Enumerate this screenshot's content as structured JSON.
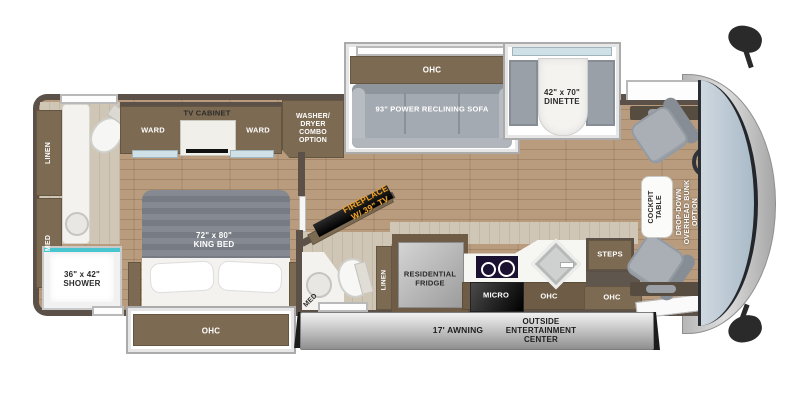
{
  "colors": {
    "wood": "#b89b7d",
    "cabinet": "#7c6a52",
    "wall": "#5b5148",
    "shower_teal": "#49c5cf",
    "fireplace_orange": "#f0a32f"
  },
  "labels": {
    "ohc": "OHC",
    "rear_bath": {
      "linen": "LINEN",
      "med": "MED"
    },
    "bedroom": {
      "ward_left": "WARD",
      "tv_cabinet": "TV CABINET",
      "ward_right": "WARD",
      "bed_size": "72\" x 80\"",
      "bed_name": "KING BED"
    },
    "washer": {
      "l1": "WASHER/",
      "l2": "DRYER",
      "l3": "COMBO",
      "l4": "OPTION"
    },
    "shower": {
      "size": "36\" x 42\"",
      "name": "SHOWER"
    },
    "sofa": "93\" POWER RECLINING SOFA",
    "dinette": {
      "size": "42\" x 70\"",
      "name": "DINETTE"
    },
    "fireplace": {
      "l1": "FIREPLACE",
      "l2": "W/ 39\" TV"
    },
    "mid_bath": {
      "med": "MED",
      "linen": "LINEN"
    },
    "kitchen": {
      "fridge_l1": "RESIDENTIAL",
      "fridge_l2": "FRIDGE",
      "micro": "MICRO"
    },
    "entry": {
      "steps": "STEPS"
    },
    "cockpit": {
      "table_l1": "COCKPIT",
      "table_l2": "TABLE",
      "bunk_l1": "DROP-DOWN",
      "bunk_l2": "OVERHEAD BUNK",
      "bunk_l3": "OPTION"
    },
    "exterior": {
      "awning": "17' AWNING",
      "oec_l1": "OUTSIDE",
      "oec_l2": "ENTERTAINMENT",
      "oec_l3": "CENTER"
    }
  }
}
